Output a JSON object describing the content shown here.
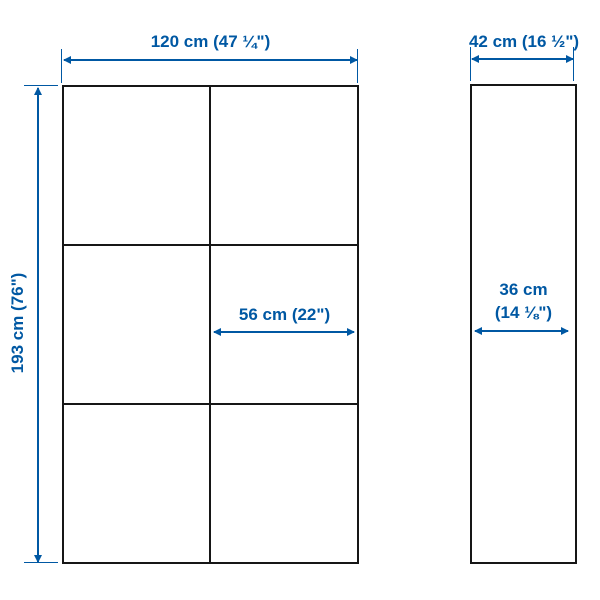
{
  "diagram_title": "furniture-dimension-diagram",
  "labels": {
    "width": "120 cm (47 ¼\")",
    "depth": "42 cm (16 ½\")",
    "height": "193 cm (76\")",
    "inner_width": "56 cm (22\")",
    "inner_depth_line1": "36 cm",
    "inner_depth_line2": "(14 ⅛\")"
  },
  "views": {
    "front": {
      "columns": 2,
      "rows": 3
    },
    "side": {
      "columns": 1,
      "rows": 1
    }
  },
  "colors": {
    "accent": "#0058a3",
    "line": "#161616",
    "background": "#ffffff"
  }
}
